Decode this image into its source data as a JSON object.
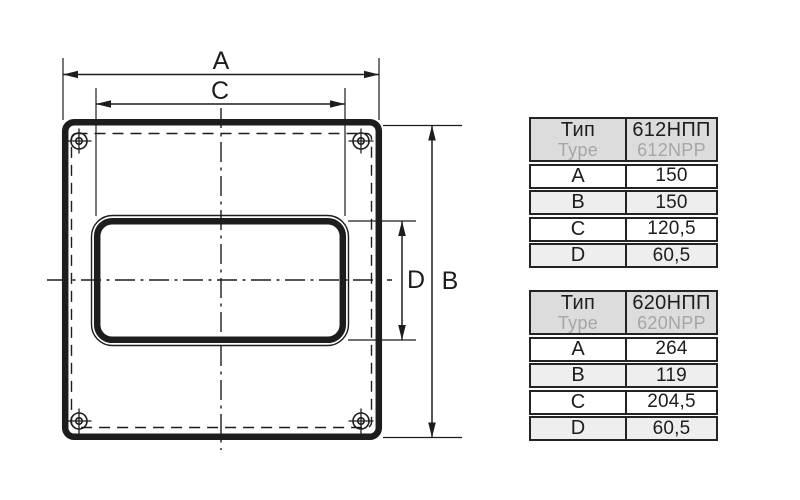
{
  "figure": {
    "dim_labels": {
      "a": "A",
      "b": "B",
      "c": "C",
      "d": "D"
    },
    "line_color": "#1d1d1b"
  },
  "tables": [
    {
      "header": {
        "type_ru": "Тип",
        "type_en": "Type",
        "model_ru": "612НПП",
        "model_en": "612NPP"
      },
      "rows": [
        {
          "param": "A",
          "value": "150"
        },
        {
          "param": "B",
          "value": "150"
        },
        {
          "param": "C",
          "value": "120,5"
        },
        {
          "param": "D",
          "value": "60,5"
        }
      ]
    },
    {
      "header": {
        "type_ru": "Тип",
        "type_en": "Type",
        "model_ru": "620НПП",
        "model_en": "620NPP"
      },
      "rows": [
        {
          "param": "A",
          "value": "264"
        },
        {
          "param": "B",
          "value": "119"
        },
        {
          "param": "C",
          "value": "204,5"
        },
        {
          "param": "D",
          "value": "60,5"
        }
      ]
    }
  ],
  "colors": {
    "line": "#1d1d1b",
    "table_border": "#232323",
    "header_bg": "#dcdcdc",
    "row_alt_bg": "#eeeeee",
    "secondary_text": "#a6a6a6"
  }
}
